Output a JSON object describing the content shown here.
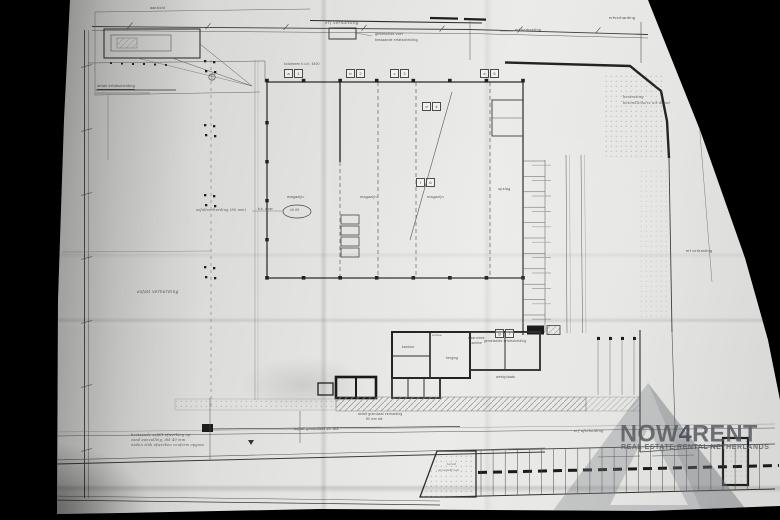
{
  "photo": {
    "background": "#000000",
    "paper_color": "#e3e3e1"
  },
  "watermark": {
    "brand_prefix": "NOW",
    "brand_digit": "4",
    "brand_suffix": "RENT",
    "tagline": "REAL ESTATE RENTAL NETHERLANDS",
    "brand_color": "#54575d",
    "digit_color": "#3a4150",
    "tagline_color": "#5a5e63"
  },
  "plan": {
    "hall": {
      "bays": 7
    },
    "parking": {
      "stalls": 24
    },
    "ellipse_mark": "±0.00",
    "tags": [
      {
        "a": "a",
        "b": "1",
        "x": 284,
        "y": 69
      },
      {
        "a": "b",
        "b": "2",
        "x": 346,
        "y": 69
      },
      {
        "a": "c",
        "b": "3",
        "x": 390,
        "y": 69
      },
      {
        "a": "d",
        "b": "4",
        "x": 422,
        "y": 102
      },
      {
        "a": "e",
        "b": "5",
        "x": 480,
        "y": 69
      },
      {
        "a": "f",
        "b": "6",
        "x": 416,
        "y": 178
      },
      {
        "a": "g",
        "b": "7",
        "x": 495,
        "y": 329
      }
    ],
    "labels": [
      {
        "t": "aanzicht",
        "x": 150,
        "y": 6,
        "s": 3.6
      },
      {
        "t": "detail erfafscheiding",
        "x": 97,
        "y": 84,
        "s": 3.8,
        "u": 1
      },
      {
        "t": "gemetselde voet",
        "x": 375,
        "y": 33,
        "s": 3.4
      },
      {
        "t": "bestaande erfafscheiding",
        "x": 375,
        "y": 39,
        "s": 3.4
      },
      {
        "t": "erf verharding",
        "x": 325,
        "y": 21,
        "s": 4.2,
        "i": 1
      },
      {
        "t": "erf verharding",
        "x": 515,
        "y": 28,
        "s": 3.8
      },
      {
        "t": "erfverharding",
        "x": 609,
        "y": 16,
        "s": 4
      },
      {
        "t": "asfalt verharding",
        "x": 137,
        "y": 290,
        "s": 4.4,
        "i": 1
      },
      {
        "t": "erf verharding",
        "x": 686,
        "y": 249,
        "s": 3.8
      },
      {
        "t": "bestrating",
        "x": 623,
        "y": 95,
        "s": 3.6,
        "i": 1
      },
      {
        "t": "betonklinkers uit depot",
        "x": 623,
        "y": 101,
        "s": 3.6,
        "i": 1
      },
      {
        "t": "magazijn",
        "x": 287,
        "y": 195,
        "s": 3.8
      },
      {
        "t": "magazijn",
        "x": 360,
        "y": 195,
        "s": 3.8
      },
      {
        "t": "magazijn",
        "x": 427,
        "y": 195,
        "s": 3.8
      },
      {
        "t": "opslag",
        "x": 498,
        "y": 187,
        "s": 3.8
      },
      {
        "t": "kolommen h.o.h. 5400",
        "x": 284,
        "y": 63,
        "s": 3.2
      },
      {
        "t": "asfaltverharding (80 mm)",
        "x": 196,
        "y": 208,
        "s": 3.5,
        "i": 1
      },
      {
        "t": "b.k. vloer",
        "x": 258,
        "y": 208,
        "s": 3.2
      },
      {
        "t": "±0.00",
        "x": 290,
        "y": 209,
        "s": 3.4
      },
      {
        "t": "entree",
        "x": 432,
        "y": 334,
        "s": 3.1
      },
      {
        "t": "kantoor",
        "x": 402,
        "y": 346,
        "s": 3.4
      },
      {
        "t": "wasruimte",
        "x": 468,
        "y": 337,
        "s": 3.3
      },
      {
        "t": "kantine",
        "x": 470,
        "y": 342,
        "s": 3.3
      },
      {
        "t": "berging",
        "x": 446,
        "y": 357,
        "s": 3.2
      },
      {
        "t": "werkplaats",
        "x": 496,
        "y": 375,
        "s": 3.6
      },
      {
        "t": "gemetselde erfafscheiding",
        "x": 484,
        "y": 340,
        "s": 3.2
      },
      {
        "t": "asfalt granulaat verharding",
        "x": 358,
        "y": 413,
        "s": 3.3
      },
      {
        "t": "80 mm dik",
        "x": 366,
        "y": 418,
        "s": 3.2
      },
      {
        "t": "bestaande asfalt afwerking op",
        "x": 131,
        "y": 433,
        "s": 3.5,
        "i": 1
      },
      {
        "t": "zand aanvulling, dik 40 mm",
        "x": 131,
        "y": 438,
        "s": 3.5,
        "i": 1
      },
      {
        "t": "naden vlak afwerken conform opgave",
        "x": 131,
        "y": 443,
        "s": 3.5,
        "i": 1
      },
      {
        "t": "asfalt granulaat 40 dik",
        "x": 294,
        "y": 427,
        "s": 3.5,
        "i": 1
      },
      {
        "t": "erf afscheiding",
        "x": 574,
        "y": 429,
        "s": 3.5,
        "i": 1
      },
      {
        "t": "talud",
        "x": 447,
        "y": 463,
        "s": 3.1,
        "i": 1
      },
      {
        "t": "groenstrook",
        "x": 438,
        "y": 469,
        "s": 3.1,
        "i": 1
      }
    ]
  }
}
